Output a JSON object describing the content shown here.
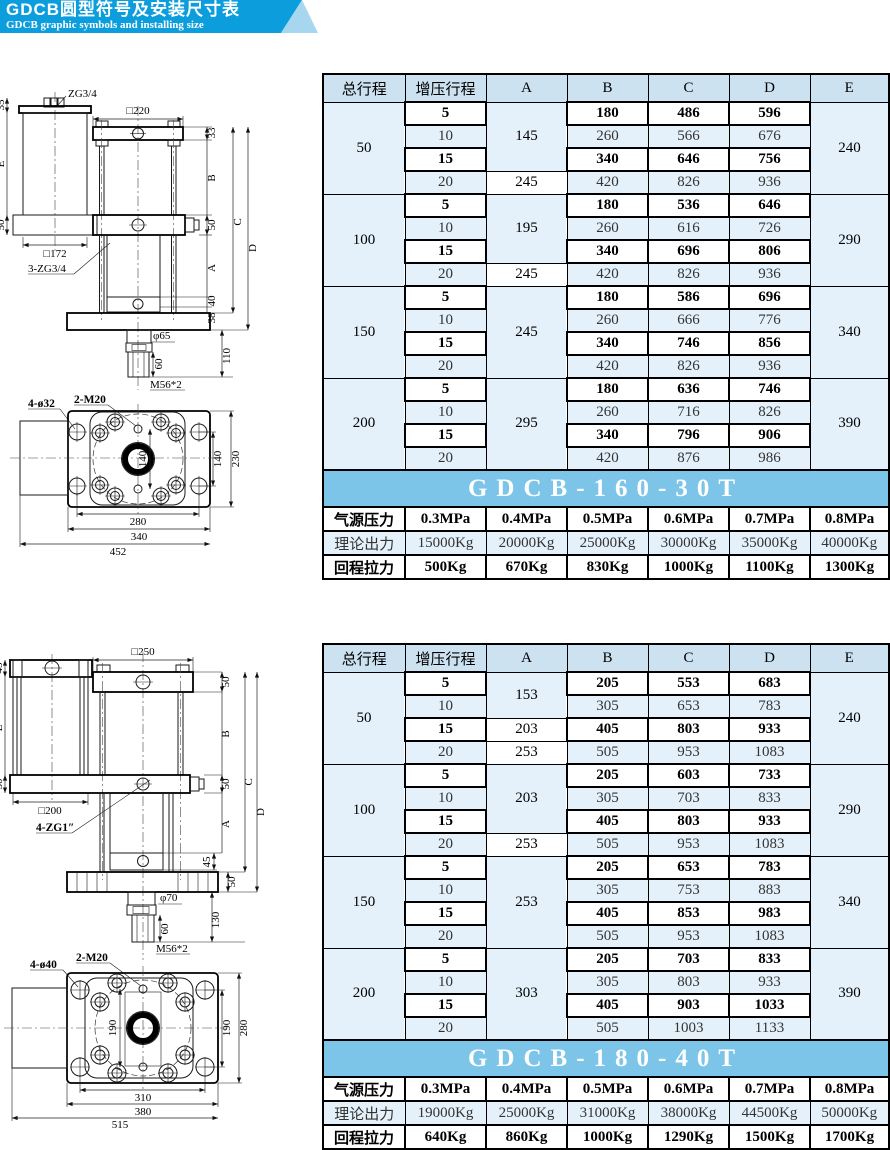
{
  "header": {
    "title": "GDCB圆型符号及安装尺寸表",
    "subtitle": "GDCB graphic symbols and installing size"
  },
  "colors": {
    "banner_blue": "#0c9ddc",
    "banner_triangle": "#a6d7ef",
    "table_header_bg": "#cde2f0",
    "row_alt_bg": "#e4f1fa",
    "model_banner_bg": "#7cc5e9"
  },
  "table1": {
    "model": "GDCB-160-30T",
    "columns": [
      "总行程",
      "增压行程",
      "A",
      "B",
      "C",
      "D",
      "E"
    ],
    "groups": [
      {
        "total": "50",
        "E": "240",
        "a_cells": [
          {
            "v": "145",
            "span": 3
          },
          {
            "v": "245",
            "span": 1
          }
        ],
        "rows": [
          [
            "5",
            "180",
            "486",
            "596"
          ],
          [
            "10",
            "260",
            "566",
            "676"
          ],
          [
            "15",
            "340",
            "646",
            "756"
          ],
          [
            "20",
            "420",
            "826",
            "936"
          ]
        ]
      },
      {
        "total": "100",
        "E": "290",
        "a_cells": [
          {
            "v": "195",
            "span": 3
          },
          {
            "v": "245",
            "span": 1
          }
        ],
        "rows": [
          [
            "5",
            "180",
            "536",
            "646"
          ],
          [
            "10",
            "260",
            "616",
            "726"
          ],
          [
            "15",
            "340",
            "696",
            "806"
          ],
          [
            "20",
            "420",
            "826",
            "936"
          ]
        ]
      },
      {
        "total": "150",
        "E": "340",
        "a_cells": [
          {
            "v": "245",
            "span": 4
          }
        ],
        "rows": [
          [
            "5",
            "180",
            "586",
            "696"
          ],
          [
            "10",
            "260",
            "666",
            "776"
          ],
          [
            "15",
            "340",
            "746",
            "856"
          ],
          [
            "20",
            "420",
            "826",
            "936"
          ]
        ]
      },
      {
        "total": "200",
        "E": "390",
        "a_cells": [
          {
            "v": "295",
            "span": 4
          }
        ],
        "rows": [
          [
            "5",
            "180",
            "636",
            "746"
          ],
          [
            "10",
            "260",
            "716",
            "826"
          ],
          [
            "15",
            "340",
            "796",
            "906"
          ],
          [
            "20",
            "420",
            "876",
            "986"
          ]
        ]
      }
    ],
    "spec_rows": [
      {
        "label": "气源压力",
        "style": "bold",
        "values": [
          "0.3MPa",
          "0.4MPa",
          "0.5MPa",
          "0.6MPa",
          "0.7MPa",
          "0.8MPa"
        ]
      },
      {
        "label": "理论出力",
        "style": "alt2",
        "values": [
          "15000Kg",
          "20000Kg",
          "25000Kg",
          "30000Kg",
          "35000Kg",
          "40000Kg"
        ]
      },
      {
        "label": "回程拉力",
        "style": "bold",
        "values": [
          "500Kg",
          "670Kg",
          "830Kg",
          "1000Kg",
          "1100Kg",
          "1300Kg"
        ]
      }
    ]
  },
  "table2": {
    "model": "GDCB-180-40T",
    "columns": [
      "总行程",
      "增压行程",
      "A",
      "B",
      "C",
      "D",
      "E"
    ],
    "groups": [
      {
        "total": "50",
        "E": "240",
        "a_cells": [
          {
            "v": "153",
            "span": 2
          },
          {
            "v": "203",
            "span": 1
          },
          {
            "v": "253",
            "span": 1
          }
        ],
        "rows": [
          [
            "5",
            "205",
            "553",
            "683"
          ],
          [
            "10",
            "305",
            "653",
            "783"
          ],
          [
            "15",
            "405",
            "803",
            "933"
          ],
          [
            "20",
            "505",
            "953",
            "1083"
          ]
        ]
      },
      {
        "total": "100",
        "E": "290",
        "a_cells": [
          {
            "v": "203",
            "span": 3
          },
          {
            "v": "253",
            "span": 1
          }
        ],
        "rows": [
          [
            "5",
            "205",
            "603",
            "733"
          ],
          [
            "10",
            "305",
            "703",
            "833"
          ],
          [
            "15",
            "405",
            "803",
            "933"
          ],
          [
            "20",
            "505",
            "953",
            "1083"
          ]
        ]
      },
      {
        "total": "150",
        "E": "340",
        "a_cells": [
          {
            "v": "253",
            "span": 4
          }
        ],
        "rows": [
          [
            "5",
            "205",
            "653",
            "783"
          ],
          [
            "10",
            "305",
            "753",
            "883"
          ],
          [
            "15",
            "405",
            "853",
            "983"
          ],
          [
            "20",
            "505",
            "953",
            "1083"
          ]
        ]
      },
      {
        "total": "200",
        "E": "390",
        "a_cells": [
          {
            "v": "303",
            "span": 4
          }
        ],
        "rows": [
          [
            "5",
            "205",
            "703",
            "833"
          ],
          [
            "10",
            "305",
            "803",
            "933"
          ],
          [
            "15",
            "405",
            "903",
            "1033"
          ],
          [
            "20",
            "505",
            "1003",
            "1133"
          ]
        ]
      }
    ],
    "spec_rows": [
      {
        "label": "气源压力",
        "style": "bold",
        "values": [
          "0.3MPa",
          "0.4MPa",
          "0.5MPa",
          "0.6MPa",
          "0.7MPa",
          "0.8MPa"
        ]
      },
      {
        "label": "理论出力",
        "style": "alt2",
        "values": [
          "19000Kg",
          "25000Kg",
          "31000Kg",
          "38000Kg",
          "44500Kg",
          "50000Kg"
        ]
      },
      {
        "label": "回程拉力",
        "style": "bold",
        "values": [
          "640Kg",
          "860Kg",
          "1000Kg",
          "1290Kg",
          "1500Kg",
          "1700Kg"
        ]
      }
    ]
  },
  "drawing1": {
    "port_label": "ZG3/4",
    "dim_35": "35",
    "dim_E": "E",
    "dim_50_left": "50",
    "sq_172": "□172",
    "label_3zg": "3-ZG3/4",
    "sq_220": "□220",
    "dim_33": "33",
    "dim_B": "B",
    "dim_50_right": "50",
    "dim_A": "A",
    "dim_C": "C",
    "dim_D": "D",
    "dim_40": "40",
    "dim_38": "38",
    "dim_110": "110",
    "dia_rod": "φ65",
    "dim_60": "60",
    "thread": "M56*2",
    "label_holes": "4-ø32",
    "label_m20": "2-M20",
    "dim_140_inner": "140",
    "dim_140_right": "140",
    "dim_230": "230",
    "dim_280": "280",
    "dim_340": "340",
    "dim_452": "452"
  },
  "drawing2": {
    "dim_45_top": "45",
    "dim_E": "E",
    "sq_250": "□250",
    "dim_50_top": "50",
    "dim_B": "B",
    "dim_50_left": "50",
    "dim_50_right": "50",
    "sq_200": "□200",
    "label_zg1": "4-ZG1″",
    "dim_C": "C",
    "dim_D": "D",
    "dim_A": "A",
    "dim_45_mid": "45",
    "dim_50_flange": "50",
    "dia_rod": "φ70",
    "dim_60": "60",
    "dim_130": "130",
    "thread": "M56*2",
    "label_holes": "4-ø40",
    "label_m20": "2-M20",
    "dim_190_inner": "190",
    "dim_190_right": "190",
    "dim_280": "280",
    "dim_310": "310",
    "dim_380": "380",
    "dim_515": "515"
  }
}
